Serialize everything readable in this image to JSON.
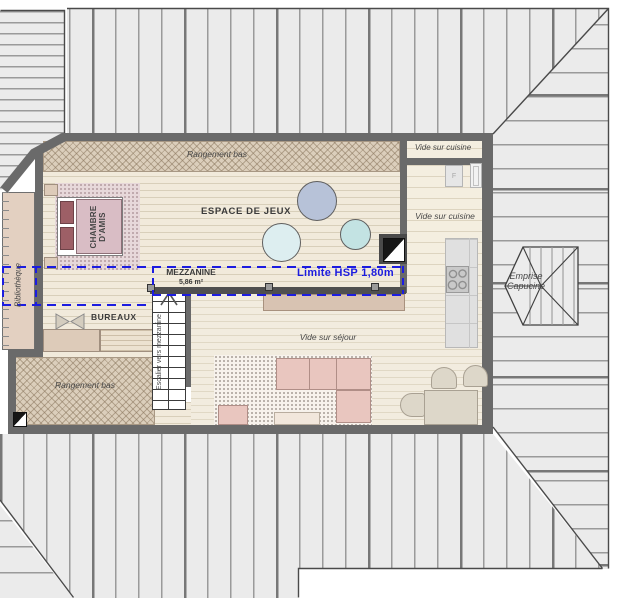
{
  "drawing": {
    "kind": "floor-plan-mezzanine",
    "accent_blue": "#1c1ce0",
    "wall_color": "#6a6a6a",
    "roof_gray": "#ebebeb"
  },
  "labels": {
    "rangement_bas_top": "Rangement bas",
    "rangement_bas_bottom": "Rangement bas",
    "vide_sur_cuisine_box": "Vide sur cuisine",
    "vide_sur_cuisine_main": "Vide sur cuisine",
    "vide_sur_sejour": "Vide sur séjour",
    "espace_de_jeux": "ESPACE DE JEUX",
    "chambre_damis": "CHAMBRE D'AMIS",
    "bureaux": "BUREAUX",
    "bibliotheque": "Bibliothèque",
    "escalier_vers_mezzanine": "Escalier vers mezzanine",
    "emprise_capucine": "Emprise Capucine",
    "mezzanine": "MEZZANINE",
    "mezzanine_surface": "5,86 m²",
    "limite_hsp": "Limite HSP 1,80m",
    "fridge_f": "F"
  }
}
